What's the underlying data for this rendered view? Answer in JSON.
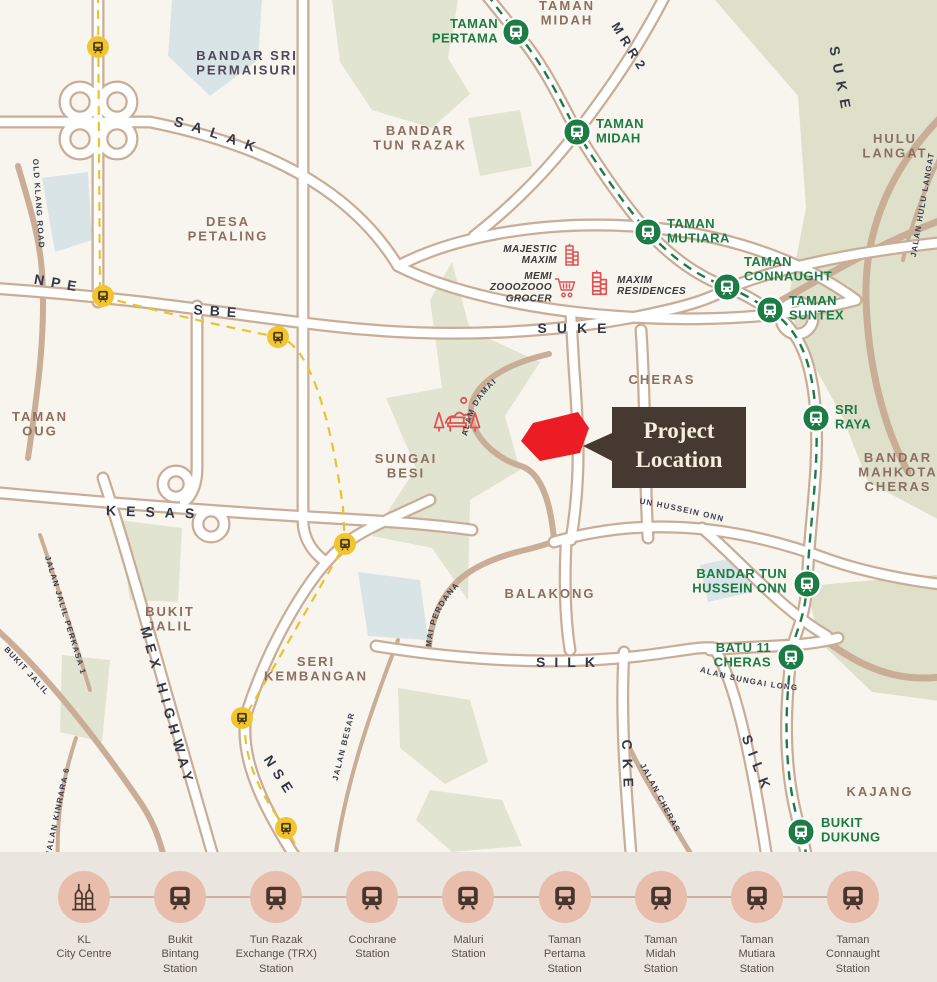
{
  "title": "Project Location Map",
  "colors": {
    "map_background": "#F8F5EF",
    "road_tan": "#C9AD97",
    "mrt_green": "#1C7C45",
    "ktm_yellow": "#F2C52D",
    "red_site": "#EC1C24",
    "callout_bg": "#453931",
    "callout_text": "#F6EFDF",
    "area_label": "#8C6F60",
    "road_label": "#333847",
    "legend_bg": "#EAE6DF",
    "legend_circle": "#E9BDAC"
  },
  "icons": {
    "train": "train-icon",
    "klcc": "klcc-towers-icon",
    "building": "building-icon",
    "cart": "shopping-cart-icon",
    "park": "park-bench-icon"
  },
  "map": {
    "callout": {
      "line1": "Project",
      "line2": "Location"
    },
    "labels": [
      {
        "t": "TAMAN\nMIDAH",
        "x": 567,
        "y": 10,
        "c": "area"
      },
      {
        "t": "BANDAR SRI\nPERMAISURI",
        "x": 247,
        "y": 60,
        "c": "aread"
      },
      {
        "t": "BANDAR\nTUN RAZAK",
        "x": 420,
        "y": 135,
        "c": "area"
      },
      {
        "t": "HULU\nLANGAT",
        "x": 895,
        "y": 143,
        "c": "area"
      },
      {
        "t": "DESA\nPETALING",
        "x": 228,
        "y": 226,
        "c": "area"
      },
      {
        "t": "CHERAS",
        "x": 662,
        "y": 384,
        "c": "area"
      },
      {
        "t": "TAMAN\nOUG",
        "x": 40,
        "y": 421,
        "c": "area"
      },
      {
        "t": "SUNGAI\nBESI",
        "x": 406,
        "y": 463,
        "c": "area"
      },
      {
        "t": "BANDAR\nMAHKOTA\nCHERAS",
        "x": 898,
        "y": 462,
        "c": "area"
      },
      {
        "t": "BALAKONG",
        "x": 550,
        "y": 598,
        "c": "area"
      },
      {
        "t": "BUKIT\nJALIL",
        "x": 170,
        "y": 616,
        "c": "area"
      },
      {
        "t": "SERI\nKEMBANGAN",
        "x": 316,
        "y": 666,
        "c": "area"
      },
      {
        "t": "KAJANG",
        "x": 880,
        "y": 796,
        "c": "area"
      },
      {
        "t": "SALAK",
        "p": "pSalak",
        "o": "30%",
        "c": "road",
        "ls": 9
      },
      {
        "t": "NPE",
        "x": 58,
        "y": 288,
        "r": 10,
        "c": "road",
        "ls": 7
      },
      {
        "t": "SBE",
        "x": 218,
        "y": 316,
        "r": 4,
        "c": "road",
        "ls": 7
      },
      {
        "t": "MRR2",
        "x": 626,
        "y": 50,
        "r": 58,
        "c": "road",
        "ls": 5,
        "s": 13
      },
      {
        "t": "SUKE",
        "x": 577,
        "y": 333,
        "c": "road",
        "ls": 10
      },
      {
        "t": "SUKE",
        "x": 836,
        "y": 82,
        "r": 79,
        "c": "road",
        "ls": 8
      },
      {
        "t": "KESAS",
        "x": 155,
        "y": 517,
        "r": 2,
        "c": "road",
        "ls": 10
      },
      {
        "t": "MEX HIGHWAY",
        "x": 163,
        "y": 708,
        "r": 74,
        "c": "road",
        "ls": 6
      },
      {
        "t": "NSE",
        "x": 276,
        "y": 779,
        "r": 57,
        "c": "road",
        "ls": 6
      },
      {
        "t": "SILK",
        "x": 570,
        "y": 667,
        "c": "road",
        "ls": 9
      },
      {
        "t": "SILK",
        "x": 753,
        "y": 767,
        "r": 69,
        "c": "road",
        "ls": 8
      },
      {
        "t": "CKE",
        "x": 623,
        "y": 768,
        "r": 88,
        "c": "road",
        "ls": 9
      },
      {
        "t": "OLD KLANG ROAD",
        "x": 36,
        "y": 204,
        "r": 86,
        "c": "rs"
      },
      {
        "t": "JALAN HULU LANGAT",
        "x": 925,
        "y": 205,
        "r": -80,
        "c": "rs"
      },
      {
        "t": "LINGKUNGAN ALAM DAMAI",
        "p": "pLing",
        "o": "2%",
        "c": "rs"
      },
      {
        "t": "LEBUH UTAMA TUN HUSSEIN ONN",
        "p": "pLebuh",
        "o": "0%",
        "c": "rs"
      },
      {
        "t": "PERSIARAN DAMAI PERDANA",
        "p": "pPers",
        "o": "0%",
        "c": "rs"
      },
      {
        "t": "JALAN BESAR",
        "x": 346,
        "y": 747,
        "r": -76,
        "c": "rs"
      },
      {
        "t": "JALAN JALIL PERKASA 1",
        "x": 63,
        "y": 616,
        "r": 73,
        "c": "rs"
      },
      {
        "t": "LEBUHRAYA BUKIT JALIL",
        "p": "pLbj",
        "o": "2%",
        "c": "rs"
      },
      {
        "t": "JALAN KINRARA 6",
        "x": 60,
        "y": 812,
        "r": -78,
        "c": "rs"
      },
      {
        "t": "JALAN SUNGAI LONG",
        "p": "pJsl",
        "o": "20%",
        "c": "rs"
      },
      {
        "t": "JALAN CHERAS",
        "x": 658,
        "y": 799,
        "r": 62,
        "c": "rs"
      },
      {
        "t": "MAJESTIC\nMAXIM",
        "x": 557,
        "y": 252,
        "a": "end",
        "c": "poi"
      },
      {
        "t": "MEMI\nZOOOZOOO\nGROCER",
        "x": 552,
        "y": 279,
        "a": "end",
        "c": "poi"
      },
      {
        "t": "MAXIM\nRESIDENCES",
        "x": 617,
        "y": 283,
        "a": "start",
        "c": "poi"
      },
      {
        "t": "TAMAN\nPERTAMA",
        "x": 498,
        "y": 28,
        "a": "end",
        "c": "grn"
      },
      {
        "t": "TAMAN\nMIDAH",
        "x": 596,
        "y": 128,
        "a": "start",
        "c": "grn"
      },
      {
        "t": "TAMAN\nMUTIARA",
        "x": 667,
        "y": 228,
        "a": "start",
        "c": "grn"
      },
      {
        "t": "TAMAN\nCONNAUGHT",
        "x": 744,
        "y": 266,
        "a": "start",
        "c": "grn"
      },
      {
        "t": "TAMAN\nSUNTEX",
        "x": 789,
        "y": 305,
        "a": "start",
        "c": "grn"
      },
      {
        "t": "SRI\nRAYA",
        "x": 835,
        "y": 414,
        "a": "start",
        "c": "grn"
      },
      {
        "t": "BANDAR TUN\nHUSSEIN ONN",
        "x": 787,
        "y": 578,
        "a": "end",
        "c": "grn"
      },
      {
        "t": "BATU 11\nCHERAS",
        "x": 771,
        "y": 652,
        "a": "end",
        "c": "grn"
      },
      {
        "t": "BUKIT\nDUKUNG",
        "x": 821,
        "y": 827,
        "a": "start",
        "c": "grn"
      }
    ],
    "mrt_stations": [
      {
        "x": 516,
        "y": 32
      },
      {
        "x": 577,
        "y": 132
      },
      {
        "x": 648,
        "y": 232
      },
      {
        "x": 727,
        "y": 287
      },
      {
        "x": 770,
        "y": 310
      },
      {
        "x": 816,
        "y": 418
      },
      {
        "x": 807,
        "y": 584
      },
      {
        "x": 791,
        "y": 657
      },
      {
        "x": 801,
        "y": 832
      }
    ],
    "ktm_stations": [
      {
        "x": 98,
        "y": 47
      },
      {
        "x": 103,
        "y": 296
      },
      {
        "x": 278,
        "y": 337
      },
      {
        "x": 345,
        "y": 544
      },
      {
        "x": 242,
        "y": 718
      },
      {
        "x": 286,
        "y": 828
      }
    ],
    "pois": [
      {
        "name": "majestic-maxim-building-icon",
        "icon": "building",
        "x": 560,
        "y": 240,
        "w": 24,
        "h": 30
      },
      {
        "name": "memi-zooozooo-grocer-cart-icon",
        "icon": "cart",
        "x": 553,
        "y": 275,
        "w": 25,
        "h": 24
      },
      {
        "name": "maxim-residences-building-icon",
        "icon": "building",
        "x": 586,
        "y": 266,
        "w": 27,
        "h": 34
      },
      {
        "name": "alam-damai-park-icon",
        "icon": "park",
        "x": 430,
        "y": 392,
        "w": 54,
        "h": 44
      }
    ]
  },
  "legend": {
    "stations": [
      "KL\nCity Centre",
      "Bukit\nBintang\nStation",
      "Tun Razak\nExchange (TRX)\nStation",
      "Cochrane\nStation",
      "Maluri\nStation",
      "Taman\nPertama\nStation",
      "Taman\nMidah\nStation",
      "Taman\nMutiara\nStation",
      "Taman\nConnaught\nStation"
    ]
  }
}
